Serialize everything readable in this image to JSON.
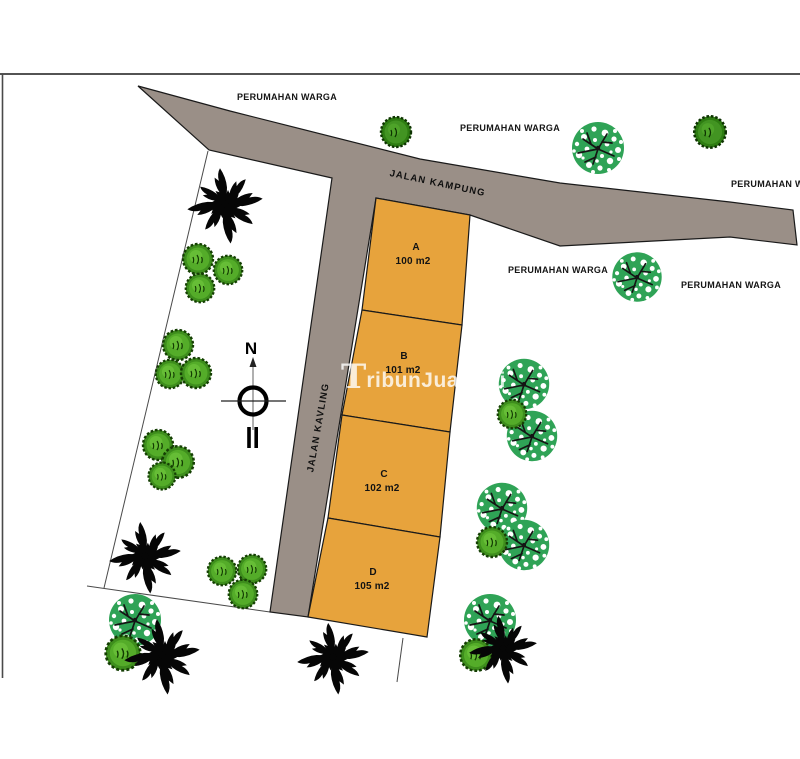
{
  "site_plan": {
    "watermark": {
      "initial": "T",
      "rest": "ribunJualBeli",
      "full": "TribunJualBeli"
    },
    "compass": {
      "north_label": "N"
    },
    "roads": {
      "kampung_label": "JALAN KAMPUNG",
      "kavling_label": "JALAN KAVLING"
    },
    "surrounding_labels": [
      "PERUMAHAN WARGA",
      "PERUMAHAN WARGA",
      "PERUMAHAN WARGA",
      "PERUMAHAN WARGA",
      "PERUMAHAN WARGA"
    ],
    "plots": [
      {
        "id": "A",
        "area": "100 m2"
      },
      {
        "id": "B",
        "area": "101 m2"
      },
      {
        "id": "C",
        "area": "102 m2"
      },
      {
        "id": "D",
        "area": "105 m2"
      }
    ],
    "colors": {
      "road": "#9a8f87",
      "plot_fill": "#e7a33c",
      "outline": "#1a1a1a",
      "tree_speckled_green": "#2fa356",
      "bush_green": "#54ac29",
      "bush_dark_green": "#429422",
      "palm_black": "#060606",
      "watermark_white": "#ffffff"
    }
  }
}
